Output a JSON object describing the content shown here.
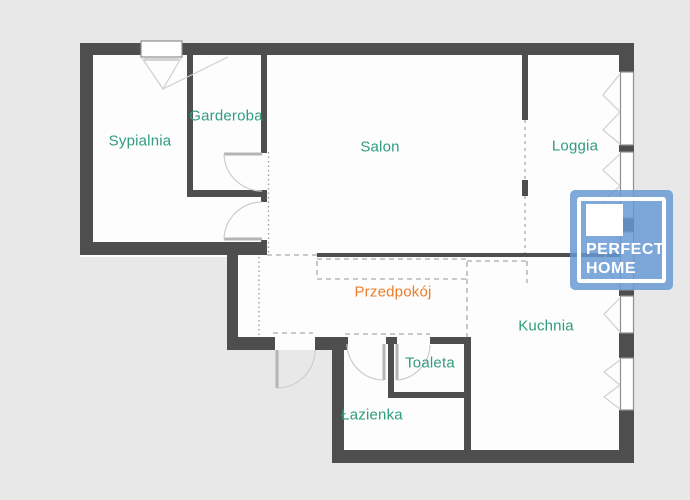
{
  "plan": {
    "background_color": "#e8e8e8",
    "floor_color": "#fdfdfd",
    "wall_color": "#4e4e4e",
    "window_frame_color": "#8f8f8f",
    "door_symbol_color": "#bdbdbd",
    "dashed_guide_color": "#aaaaaa",
    "room_label_color": "#2f9c7d",
    "hallway_label_color": "#ed7c29"
  },
  "rooms": [
    {
      "id": "sypialnia",
      "label": "Sypialnia"
    },
    {
      "id": "garderoba",
      "label": "Garderoba"
    },
    {
      "id": "salon",
      "label": "Salon"
    },
    {
      "id": "loggia",
      "label": "Loggia"
    },
    {
      "id": "przedpokoj",
      "label": "Przedpokój"
    },
    {
      "id": "kuchnia",
      "label": "Kuchnia"
    },
    {
      "id": "toaleta",
      "label": "Toaleta"
    },
    {
      "id": "lazienka",
      "label": "Łazienka"
    }
  ],
  "logo": {
    "line1": "PERFECT",
    "line2": "HOME",
    "color": "#6898d4"
  }
}
